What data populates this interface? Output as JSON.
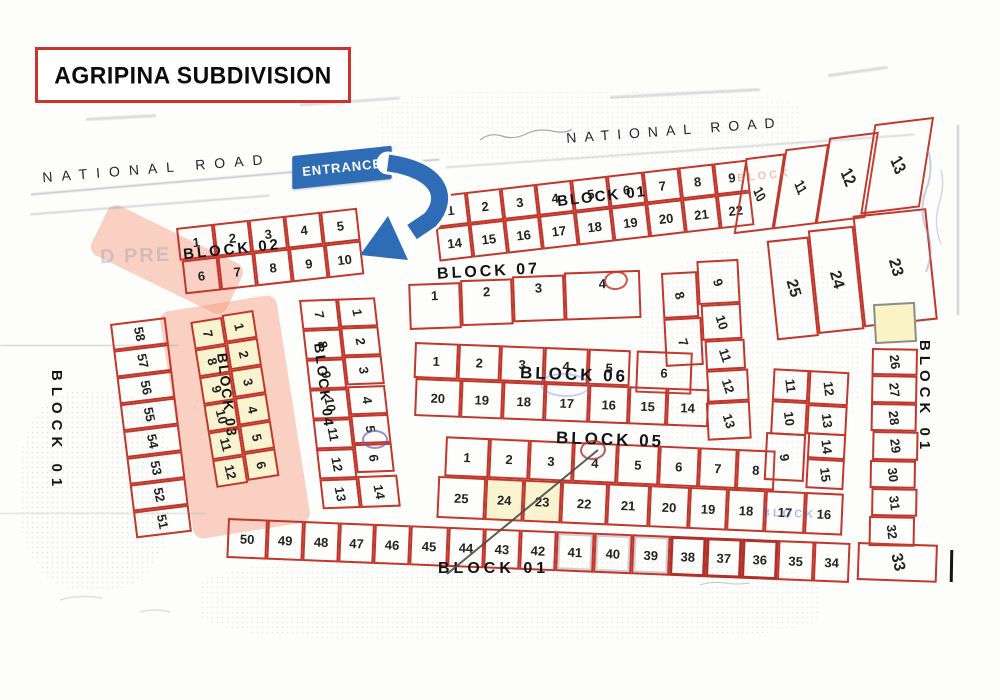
{
  "title": "AGRIPINA SUBDIVISION",
  "roads": {
    "left": "NATIONAL ROAD",
    "right": "NATIONAL ROAD",
    "entrance": "ENTRANCE"
  },
  "watermarks": {
    "gray": "D PRE",
    "blue": "BLOCK",
    "orange": "BLOCK"
  },
  "labels": {
    "block01": "BLOCK 01",
    "block02": "BLOCK 02",
    "block03": "BLOCK 03",
    "block04": "BLOCK 04",
    "block05": "BLOCK 05",
    "block06": "BLOCK 06",
    "block07": "BLOCK 07"
  },
  "blocks": {
    "block01_north": {
      "lots": [
        "1",
        "2",
        "3",
        "4",
        "5",
        "6",
        "7",
        "8",
        "9",
        "14",
        "15",
        "16",
        "17",
        "18",
        "19",
        "20",
        "21",
        "22",
        "10",
        "11",
        "12",
        "13"
      ]
    },
    "block01_west": {
      "lots": [
        "58",
        "57",
        "56",
        "55",
        "54",
        "53",
        "52",
        "51"
      ]
    },
    "block01_south": {
      "lots": [
        "50",
        "49",
        "48",
        "47",
        "46",
        "45",
        "44",
        "43",
        "42",
        "41",
        "40",
        "39",
        "38",
        "37",
        "36",
        "35",
        "34",
        "33"
      ]
    },
    "block01_east": {
      "lots": [
        "25",
        "24",
        "23",
        "26",
        "27",
        "28",
        "29",
        "30",
        "31",
        "32"
      ]
    },
    "block02": {
      "lots": [
        "1",
        "2",
        "3",
        "4",
        "5",
        "6",
        "7",
        "8",
        "9",
        "10"
      ]
    },
    "block03": {
      "lots": [
        "1",
        "2",
        "3",
        "4",
        "5",
        "6",
        "7",
        "8",
        "9",
        "10",
        "11",
        "12"
      ]
    },
    "block04": {
      "lots": [
        "1",
        "2",
        "3",
        "4",
        "5",
        "6",
        "7",
        "8",
        "9",
        "10",
        "11",
        "12",
        "13",
        "14"
      ]
    },
    "block05": {
      "lots": [
        "1",
        "2",
        "3",
        "4",
        "5",
        "6",
        "7",
        "8",
        "25",
        "24",
        "23",
        "22",
        "21",
        "20",
        "19",
        "18",
        "17",
        "16",
        "11",
        "12",
        "10",
        "13",
        "9",
        "14",
        "15"
      ]
    },
    "block06": {
      "lots": [
        "1",
        "2",
        "3",
        "4",
        "5",
        "6",
        "20",
        "19",
        "18",
        "17",
        "16",
        "15",
        "14",
        "8",
        "9",
        "7",
        "10",
        "11",
        "12",
        "13"
      ]
    },
    "block07": {
      "lots": [
        "1",
        "2",
        "3",
        "4"
      ]
    }
  }
}
